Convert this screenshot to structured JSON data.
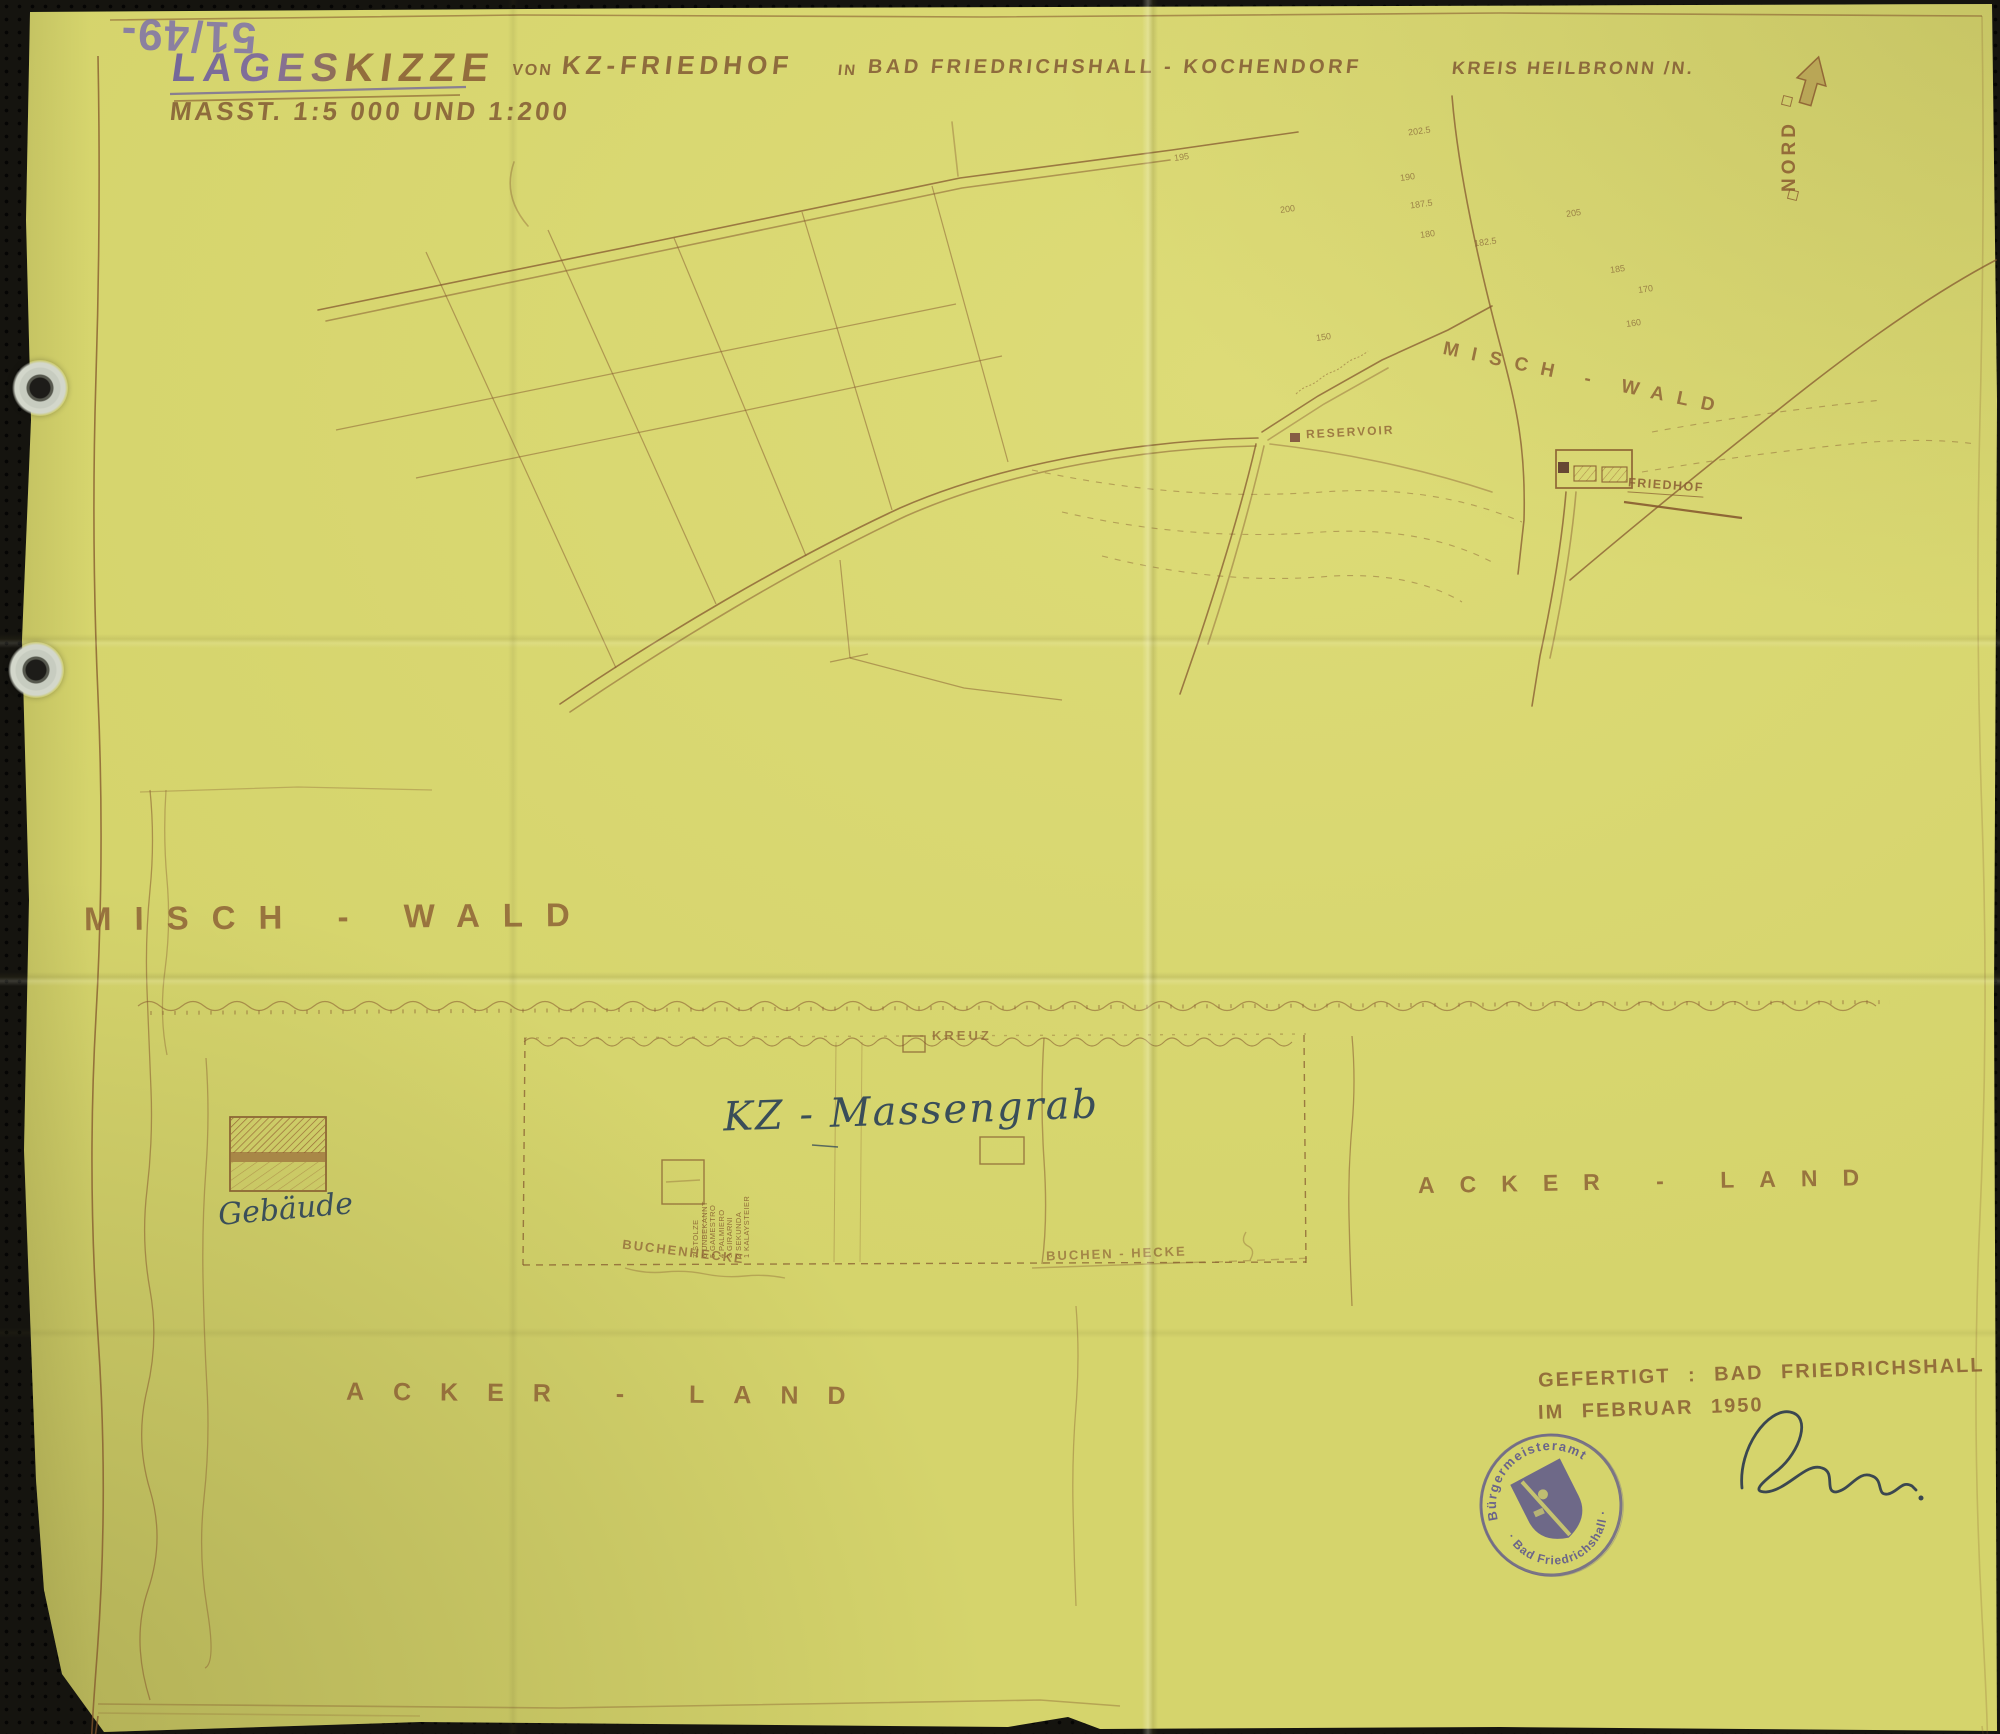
{
  "page": {
    "archive_number": "51/49-",
    "north_label": "NORD"
  },
  "title": {
    "main_word": "LAGESKIZZE",
    "connector_1": "VON",
    "subject": "KZ-FRIEDHOF",
    "connector_2": "IN",
    "place": "BAD FRIEDRICHSHALL - KOCHENDORF",
    "district": "KREIS HEILBRONN /N.",
    "scale_note": "MASST.  1:5 000  UND  1:200"
  },
  "overview_map": {
    "forest_label": "MISCH - WALD",
    "reservoir_label": "RESERVOIR",
    "cemetery_label": "FRIEDHOF",
    "elevations": [
      "202.5",
      "190",
      "187.5",
      "180",
      "182.5",
      "185",
      "170",
      "160",
      "150",
      "195",
      "200",
      "205"
    ]
  },
  "detail_plan": {
    "forest_label": "MISCH - WALD",
    "cross_label": "KREUZ",
    "mass_grave_label": "KZ - Massengrab",
    "hedge_label_left": "BUCHENHECKE",
    "hedge_label_right": "BUCHEN - HECKE",
    "field_label_right": "ACKER - LAND",
    "field_label_bottom": "ACKER - LAND",
    "building_label": "Gebäude",
    "grave_list": [
      "7 STOLZE",
      "6 UNBEKANNT",
      "5 GAMESTRO",
      "4 PALMIERO",
      "3 GIRARNI",
      "2 SEKUNDA",
      "1 KALAYSTEIER"
    ]
  },
  "footer": {
    "made_line_1": "GEFERTIGT :  BAD FRIEDRICHSHALL",
    "made_line_2": "IM FEBRUAR  1950",
    "stamp_text_top": "Bürgermeisteramt",
    "stamp_text_bottom": "· Bad Friedrichshall ·"
  },
  "colors": {
    "paper": "#d5d46c",
    "ink_sepia": "#8a5c33",
    "ink_blueblack": "#3a4e59",
    "stamp_violet": "#473f94",
    "pencil_violet": "#7e72aa"
  }
}
